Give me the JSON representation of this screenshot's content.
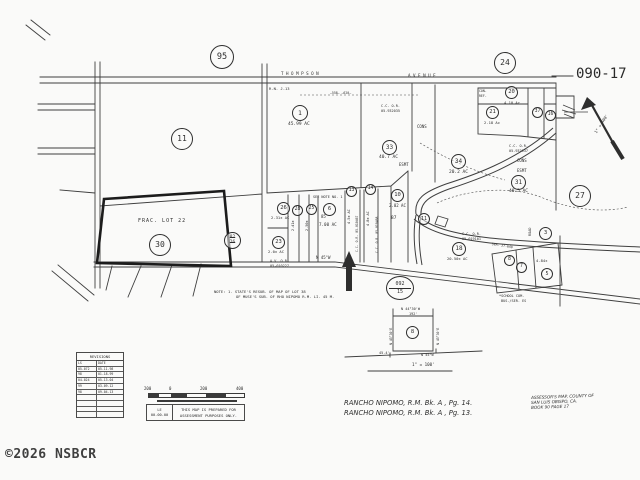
{
  "title_block": {
    "map_number": "090-17",
    "sheet_refs": {
      "top_left": "95",
      "top_right": "24",
      "right": "27"
    },
    "stamp": {
      "top": "092",
      "bottom": "15"
    },
    "copyright": "©2026 NSBCR",
    "footer": {
      "rancho_line1": "RANCHO NIPOMO, R.M. Bk. A , Pg. 14.",
      "rancho_line2": "RANCHO NIPOMO, R.M. Bk. A , Pg. 13.",
      "assessor_line1": "ASSESSOR'S MAP, COUNTY OF",
      "assessor_line2": "SAN LUIS OBISPO, CA.",
      "assessor_line3": "BOOK 90  PAGE 17"
    },
    "disclaimer": {
      "initials": "LE",
      "date": "00-00-00",
      "line1": "THIS MAP IS PREPARED FOR",
      "line2": "ASSESSMENT PURPOSES ONLY."
    },
    "scale_bar": {
      "labels": [
        "200",
        "0",
        "200",
        "400"
      ]
    },
    "north_arrow_scale": "1\" = 400'"
  },
  "revisions": {
    "title": "REVISIONS",
    "col1": "LS",
    "col2": "DATE",
    "rows": [
      [
        "05-072",
        "05-11-98"
      ],
      [
        "98",
        "01-18-99"
      ],
      [
        "04-024",
        "05-13-04"
      ],
      [
        "99",
        "03-09-12"
      ],
      [
        "98",
        "09-04-13"
      ]
    ]
  },
  "roads": {
    "thompson": "THOMPSON",
    "avenue": "AVENUE",
    "rn_ref": "R.N. J-13",
    "dim_marks": "—558—   —620—",
    "bearing_n45w": "N 45°W",
    "ser_ref": "SER. 27-640",
    "road_vert": "ROAD"
  },
  "parcels": {
    "p11": {
      "num": "11"
    },
    "p1": {
      "num": "1",
      "ac": "45.99 AC"
    },
    "p30": {
      "num": "30"
    },
    "p33": {
      "num": "33",
      "ac": "40.7 AC"
    },
    "p34": {
      "num": "34",
      "ac": "20.2 AC"
    },
    "p31": {
      "num": "31",
      "ac": "40.5 AC"
    },
    "p20": {
      "num": "20",
      "ac": "4.10 Ac"
    },
    "p21": {
      "num": "21",
      "ac": "2.18 Ac"
    },
    "p37": {
      "num": "37"
    },
    "p16": {
      "num": "16"
    },
    "p26": {
      "num": "26",
      "ac": "2.31± AC"
    },
    "p23": {
      "num": "23",
      "ac": "2.0± AC"
    },
    "p28": {
      "num": "28",
      "ac": "2.41±"
    },
    "p25": {
      "num": "25",
      "ac": "2.50±"
    },
    "p6": {
      "num": "6",
      "ac": "7.00 AC",
      "block": "85",
      "note": "SEE NOTE NO. 1"
    },
    "p13": {
      "num": "13",
      "ac": "4.5± AC"
    },
    "p14": {
      "num": "14",
      "ac": "4.8± AC"
    },
    "p10": {
      "num": "10",
      "ac": "2.02 AC",
      "block": "87"
    },
    "p11b": {
      "num": "11"
    },
    "p18": {
      "num": "18",
      "ac": "20.50± AC"
    },
    "p3": {
      "num": "3"
    },
    "p8": {
      "num": "8"
    },
    "p7": {
      "num": "7"
    },
    "p5": {
      "num": "5",
      "ac": "4.84±"
    },
    "p8_inset": {
      "num": "8"
    },
    "cancelled": {
      "a": "82",
      "b": "26"
    }
  },
  "annotations": {
    "frac_lot": "FRAC. LOT 22",
    "or_ref_1a": "C.C. O.R.",
    "or_ref_1b": "05-932035",
    "or_ref_2a": "C.C. O.R.",
    "or_ref_2b": "05-932937",
    "or_ref_3a": "C.C. O.R.",
    "or_ref_3b": "05-019101",
    "or_ref_4a": "A.V. O.R.",
    "or_ref_4b": "05-010227",
    "or_ref_5": "C.C. O.R. 05-010467",
    "or_ref_6": "C.C. O.R. 05-010468",
    "cons_1": "CONS",
    "cons_2": "CONS",
    "esmt_1": "ESMT",
    "esmt_2": "ESMT",
    "con_ref_a": "CON-",
    "con_ref_b": "REF-",
    "note_label": "NOTE:",
    "note_line1": "1. STATE'S RESUB. OF MAP OF LOT 38",
    "note_line2": "OF MUSE'S SUB. OF RHO NIPOMO R.M. LI. 45 M.",
    "school_line1": "*SCHOOL COM.",
    "school_line2": "BUS./SER. ES"
  },
  "inset": {
    "bearing_top": "N 44°30'W",
    "dim_top": "192'",
    "bearing_left": "N 45°30'E",
    "bearing_right": "N 45°30'E",
    "dim_left": "45.4'",
    "bearing_bottom": "N 45°W",
    "scale": "1\" = 100'"
  },
  "colors": {
    "ink": "#2e2e2e",
    "paper": "#fafaf9"
  }
}
